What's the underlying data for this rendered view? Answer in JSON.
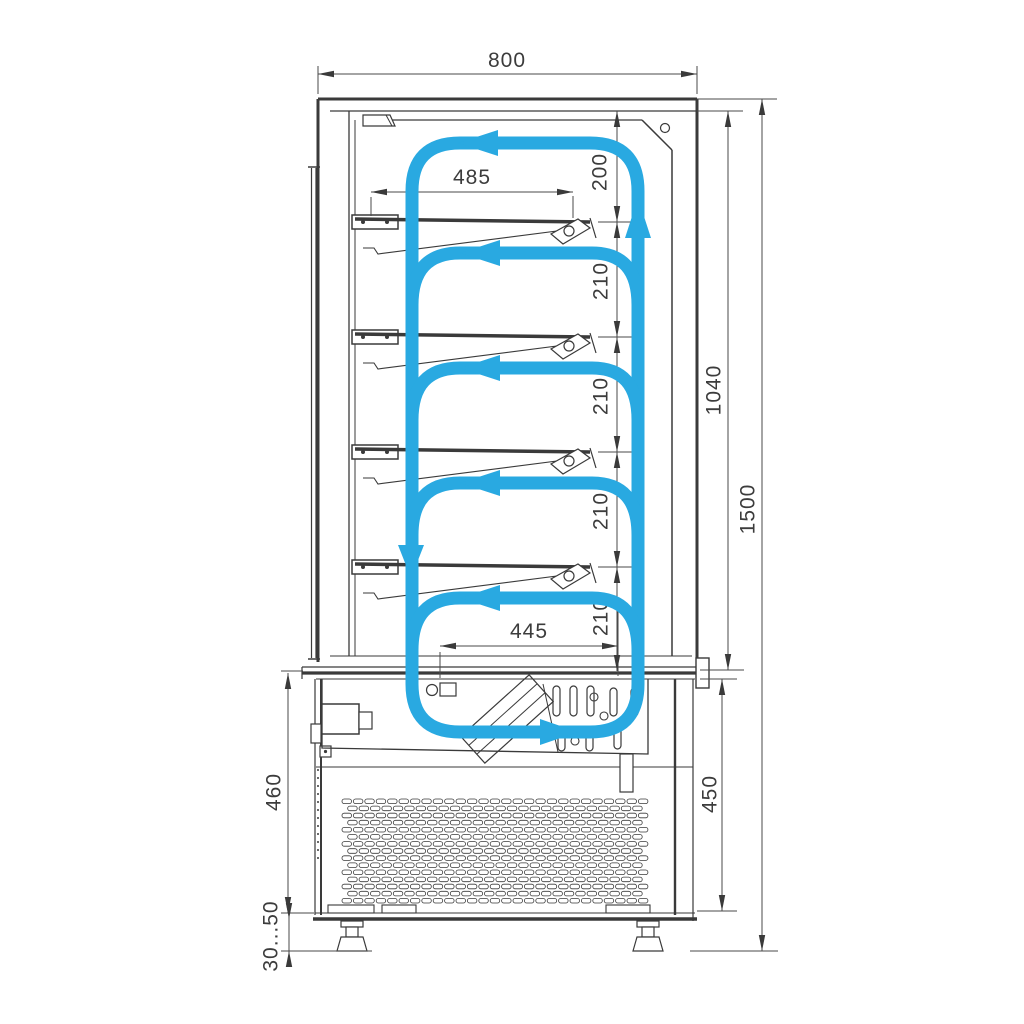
{
  "colors": {
    "airflow": "#29a9e1",
    "line": "#3a3a3a",
    "dimension": "#4a4a4a",
    "background": "#ffffff"
  },
  "dims": {
    "overall_width": "800",
    "shelf_width": "485",
    "top_gap": "200",
    "shelf_gaps": [
      "210",
      "210",
      "210",
      "210"
    ],
    "display_inner_height": "1040",
    "overall_height": "1500",
    "bottom_shelf_width": "445",
    "base_height_front": "460",
    "base_height_back": "450",
    "foot_adjustment": "30...50"
  }
}
